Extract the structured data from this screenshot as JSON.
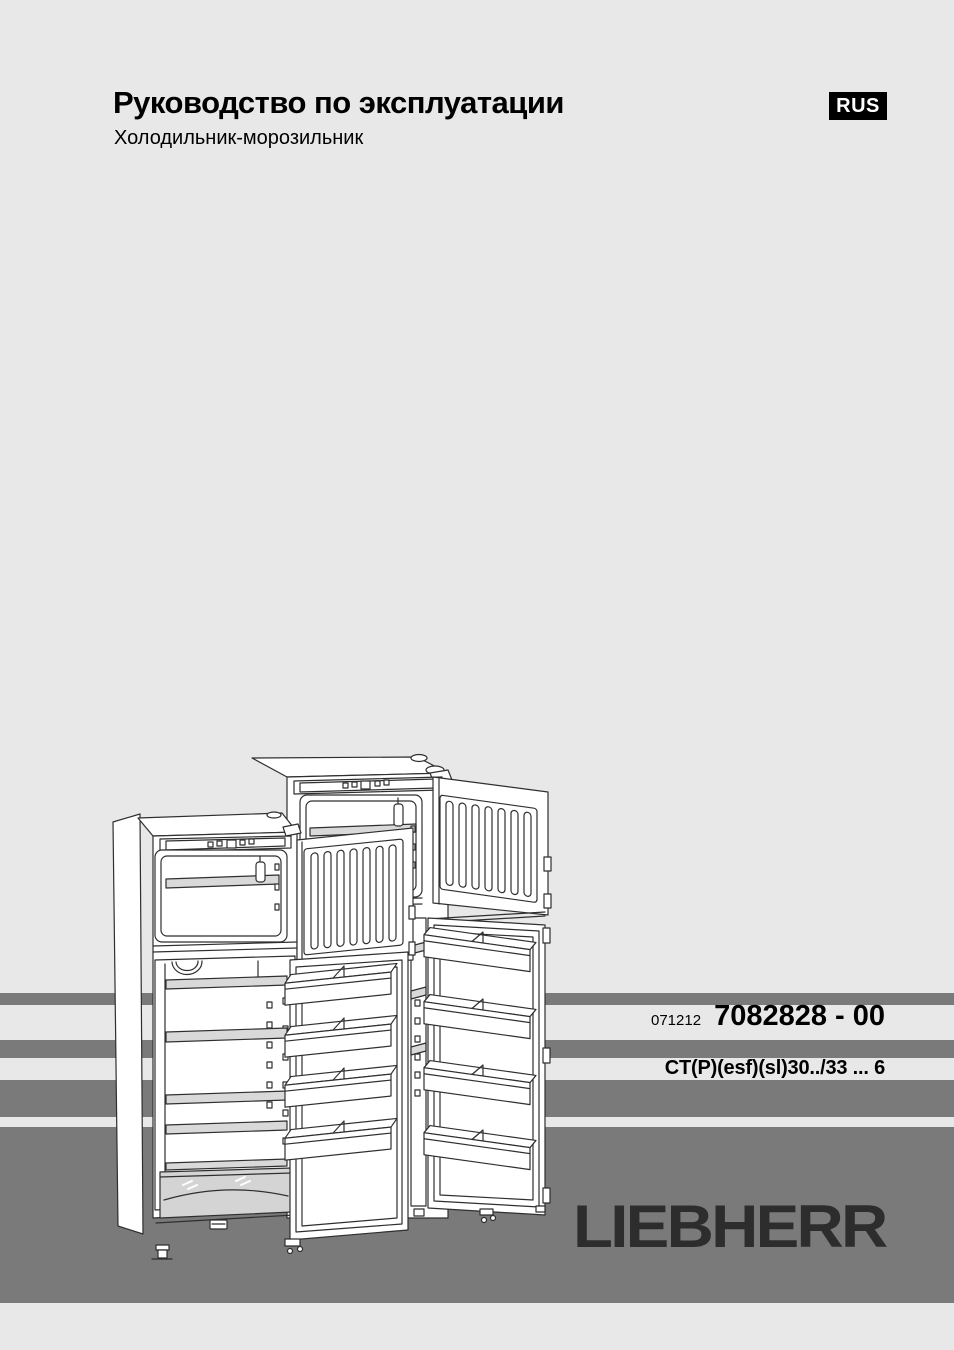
{
  "page": {
    "background_color": "#e8e8e8",
    "stripe_color": "#7a7a7a"
  },
  "header": {
    "title": "Руководство по эксплуатации",
    "subtitle": "Холодильник-морозильник",
    "language_badge": "RUS"
  },
  "document_info": {
    "date_code": "071212",
    "document_number": "7082828 - 00",
    "model_designation": "CT(P)(esf)(sl)30../33 ... 6"
  },
  "brand": {
    "logo_text": "LIEBHERR",
    "logo_color": "#2d2d2d"
  },
  "illustration": {
    "icon": "refrigerator-freezer-open-doors-line-drawing"
  }
}
